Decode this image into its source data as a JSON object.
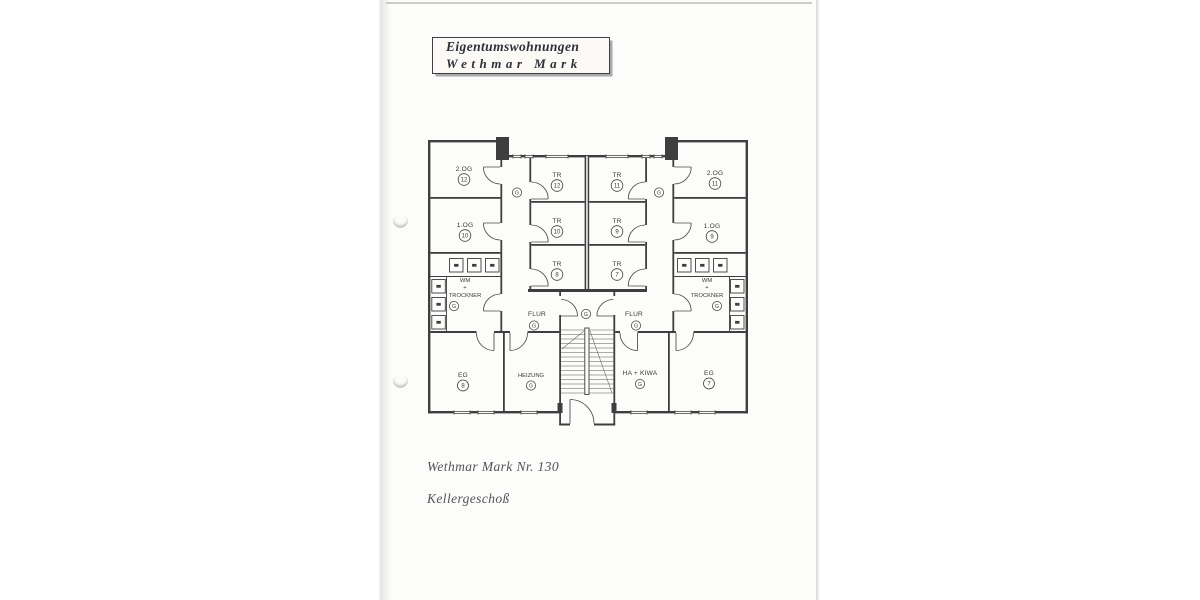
{
  "title_box": {
    "line1": "Eigentumswohnungen",
    "line2": "Wethmar Mark"
  },
  "footer": {
    "address": "Wethmar Mark Nr. 130",
    "floor": "Kellergeschoß"
  },
  "plan": {
    "colors": {
      "soft": "#edeebc",
      "strong": "#e9e492",
      "ink": "#3e3e3e"
    },
    "rooms": {
      "og2_l": {
        "label": "2.OG",
        "num": "12"
      },
      "og1_l": {
        "label": "1.OG",
        "num": "10"
      },
      "tr12": {
        "label": "TR",
        "num": "12"
      },
      "tr10": {
        "label": "TR",
        "num": "10"
      },
      "tr8": {
        "label": "TR",
        "num": "8"
      },
      "tr11": {
        "label": "TR",
        "num": "11"
      },
      "tr9": {
        "label": "TR",
        "num": "9"
      },
      "tr7": {
        "label": "TR",
        "num": "7"
      },
      "og2_r": {
        "label": "2.OG",
        "num": "11"
      },
      "og1_r": {
        "label": "1.OG",
        "num": "9"
      },
      "wm_l": {
        "line1": "WM",
        "line2": "+",
        "line3": "TROCKNER",
        "letter": "G"
      },
      "wm_r": {
        "line1": "WM",
        "line2": "+",
        "line3": "TROCKNER",
        "letter": "G"
      },
      "flur_l": {
        "label": "FLUR",
        "letter": "G"
      },
      "flur_r": {
        "label": "FLUR",
        "letter": "G"
      },
      "corridor_l": {
        "letter": "G"
      },
      "corridor_r": {
        "letter": "G"
      },
      "stair": {
        "letter": "G"
      },
      "eg8": {
        "label": "EG",
        "num": "8"
      },
      "heizung": {
        "label": "HEIZUNG",
        "letter": "G"
      },
      "hakiwa": {
        "label": "HA + KIWA",
        "letter": "G"
      },
      "eg7": {
        "label": "EG",
        "num": "7"
      }
    }
  }
}
